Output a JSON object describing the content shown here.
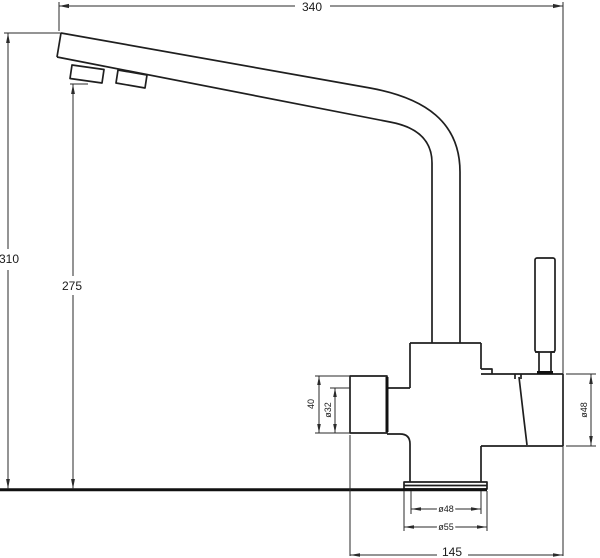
{
  "drawing": {
    "type": "faucet-technical-drawing",
    "background": "#ffffff",
    "line_color": "#1f1f1f",
    "dimensions": {
      "spout_reach": "340",
      "overall_height": "310",
      "spout_outlet_height": "275",
      "side_outlet_length": "40",
      "side_outlet_diameter": "ø32",
      "valve_body_diameter": "ø48",
      "base_pipe_diameter": "ø48",
      "base_flange_diameter": "ø55",
      "body_span": "145"
    }
  }
}
